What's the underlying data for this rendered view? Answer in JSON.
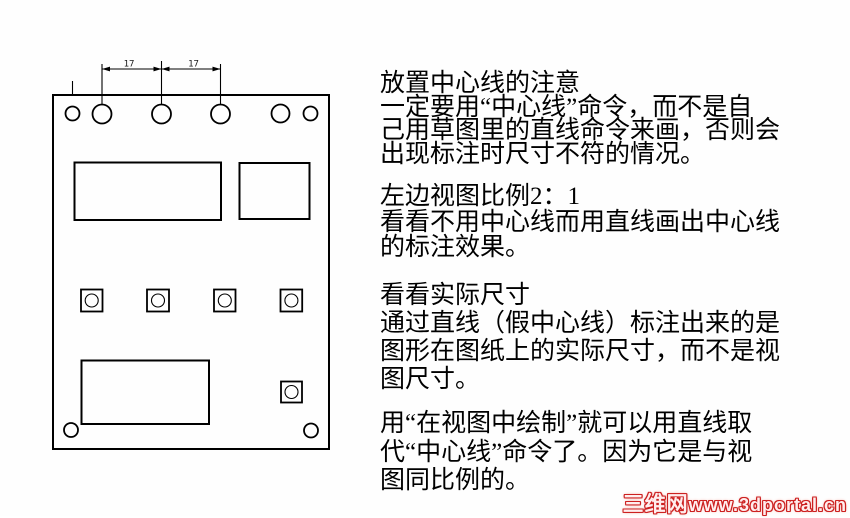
{
  "drawing": {
    "dim_labels": [
      "17",
      "17"
    ]
  },
  "text_panel": {
    "paragraphs": [
      {
        "lines": [
          "放置中心线的注意",
          "一定要用“中心线”命令，而不是自",
          "己用草图里的直线命令来画，否则会",
          "出现标注时尺寸不符的情况。"
        ]
      },
      {
        "lines": [
          "左边视图比例2：1",
          "看看不用中心线而用直线画出中心线",
          "的标注效果。"
        ]
      },
      {
        "lines": [
          "看看实际尺寸",
          "通过直线（假中心线）标注出来的是",
          "图形在图纸上的实际尺寸，而不是视",
          "图尺寸。"
        ]
      },
      {
        "lines": [
          "用“在视图中绘制”就可以用直线取",
          "代“中心线”命令了。因为它是与视",
          "图同比例的。"
        ]
      }
    ]
  },
  "watermark": {
    "cjk": "三维网",
    "latin": "www.3dportal.cn",
    "color": "#cc2020"
  }
}
